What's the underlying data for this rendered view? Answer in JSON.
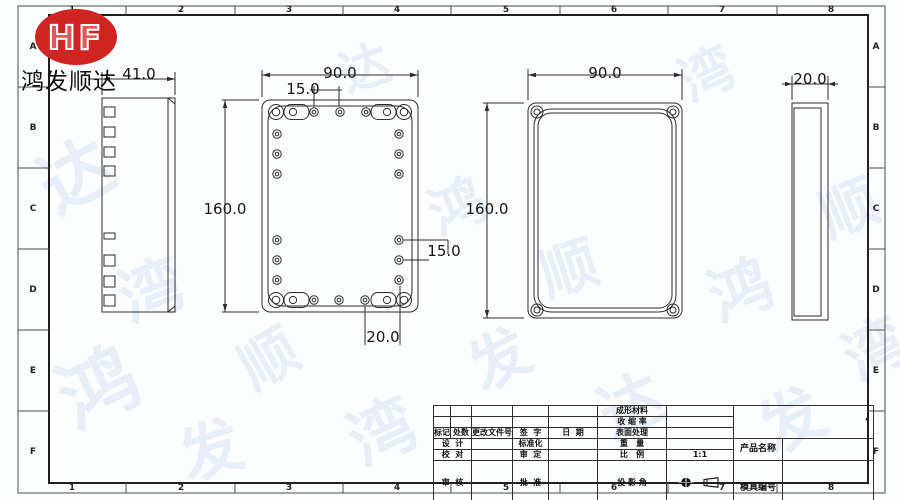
{
  "company": {
    "logo_text": "HF",
    "name": "鸿发顺达"
  },
  "colors": {
    "logo_red": "#d02421",
    "line": "#2b2b2b",
    "watermark": "#d9e2f3"
  },
  "zones": {
    "columns": [
      "1",
      "2",
      "3",
      "4",
      "5",
      "6",
      "7",
      "8"
    ],
    "rows": [
      "A",
      "B",
      "C",
      "D",
      "E",
      "F"
    ]
  },
  "dimensions": {
    "base_side_width": "41.0",
    "base_width": "90.0",
    "base_height": "160.0",
    "hole_pitch_top": "15.0",
    "hole_pitch_side": "15.0",
    "hole_pitch_bottom": "20.0",
    "lid_width": "90.0",
    "lid_height": "160.0",
    "lid_side_width": "20.0"
  },
  "title_block": {
    "molding_material": "成形材料",
    "shrinkage_rate": "收 缩 率",
    "surface_treatment": "表面处理",
    "weight": "重   量",
    "scale": "比   例",
    "scale_value": "1:1",
    "projection_angle": "投 影 角",
    "total_pages": "共   页",
    "page_number": "第   页",
    "mark": "标记",
    "count": "处数",
    "change_doc_no": "更改文件号",
    "signature": "签  字",
    "date": "日  期",
    "design": "设  计",
    "proofread": "校  对",
    "review": "审  核",
    "craft": "工  艺",
    "standardization": "标准化",
    "approval": "审  定",
    "ratify": "批  准",
    "date2": "日  期",
    "product_name": "产品名称",
    "mold_number": "模具编号",
    "note_mark": "’"
  },
  "watermark": {
    "chars": [
      "达",
      "湾",
      "鸿",
      "发",
      "顺",
      "达",
      "湾",
      "鸿",
      "发",
      "顺",
      "达",
      "湾",
      "鸿",
      "发",
      "顺",
      "湾"
    ]
  }
}
